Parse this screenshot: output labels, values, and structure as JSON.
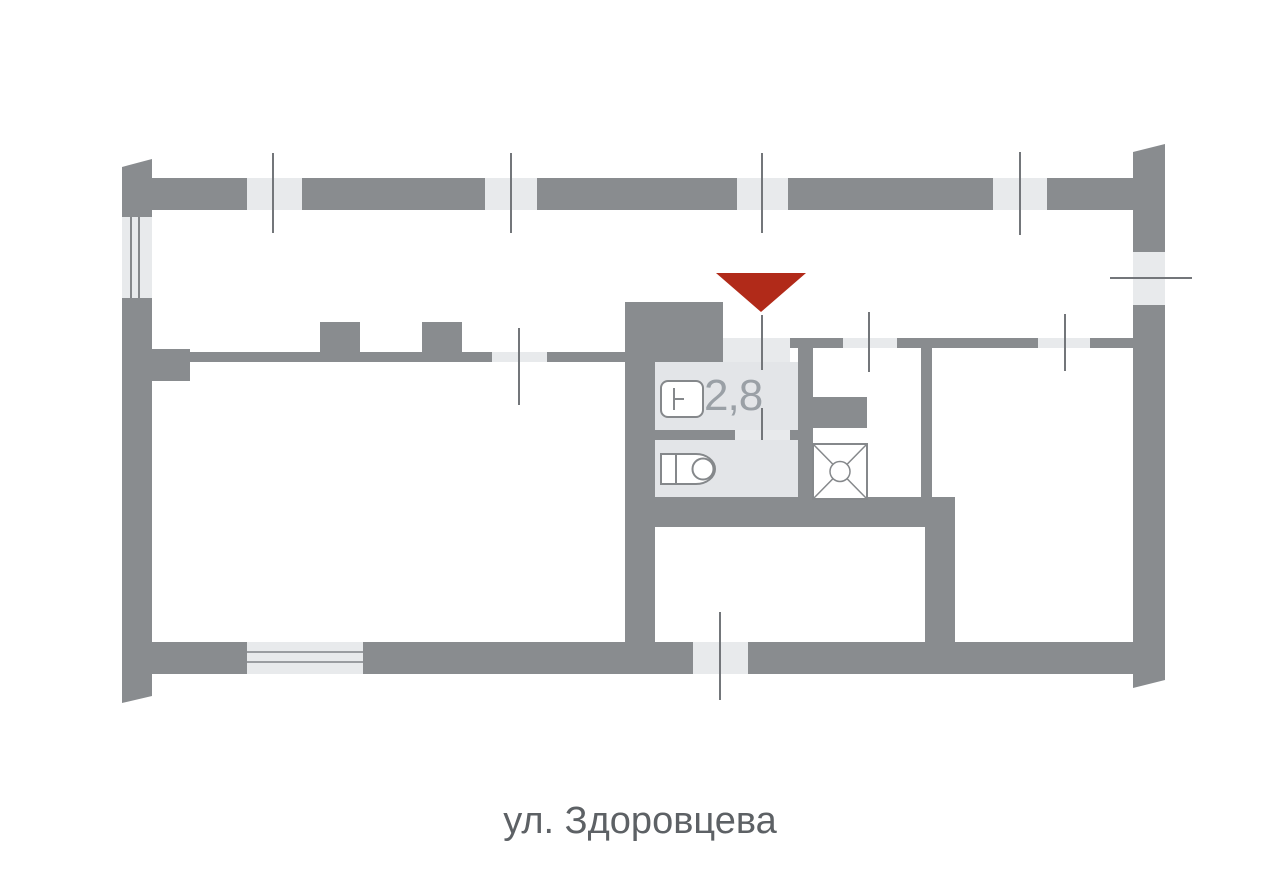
{
  "plan": {
    "room_area_label": "2,8",
    "entrance_marker_icon": "entrance-arrow-icon",
    "fixture_icons": [
      "sink-icon",
      "toilet-icon",
      "shower-tray-icon"
    ]
  },
  "caption": {
    "street_label": "ул. Здоровцева"
  },
  "colors": {
    "wall": "#898c8f",
    "opening": "#e8eaec",
    "wet_floor": "#e3e5e8",
    "entrance_accent": "#b12a19",
    "area_text": "#9aa0a6",
    "caption_text": "#5d6165",
    "tick_line": "#73767a",
    "fixture_stroke": "#85888b"
  }
}
